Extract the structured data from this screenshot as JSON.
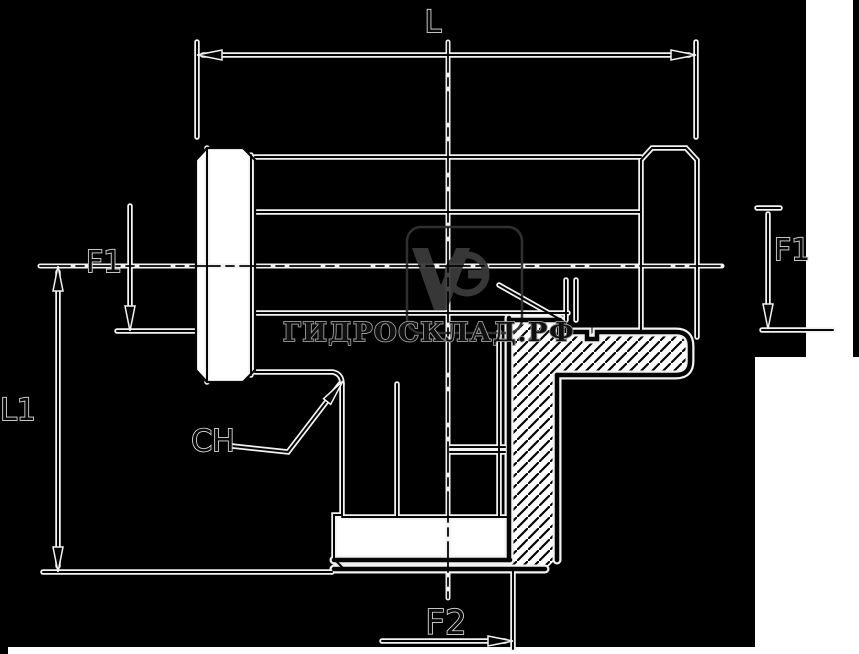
{
  "drawing": {
    "title": "Tee hydraulic fitting technical drawing",
    "labels": {
      "length_total": "L",
      "flat_left": "F1",
      "flat_right": "F1",
      "height_total": "L1",
      "wrench_size": "CH",
      "thread_bottom": "F2"
    },
    "watermark": {
      "text": "ГИДРОСКЛАД.РФ"
    },
    "logo": {
      "name": "vg-monogram"
    },
    "colors": {
      "background": "#000000",
      "ink": "#050505",
      "halo": "#f2f2f2",
      "white_fill": "#ffffff",
      "watermark_fill": "#101010",
      "watermark_outline": "#9c9c9c",
      "logo_gray": "#3a3a3a",
      "logo_box": "#333333"
    }
  }
}
